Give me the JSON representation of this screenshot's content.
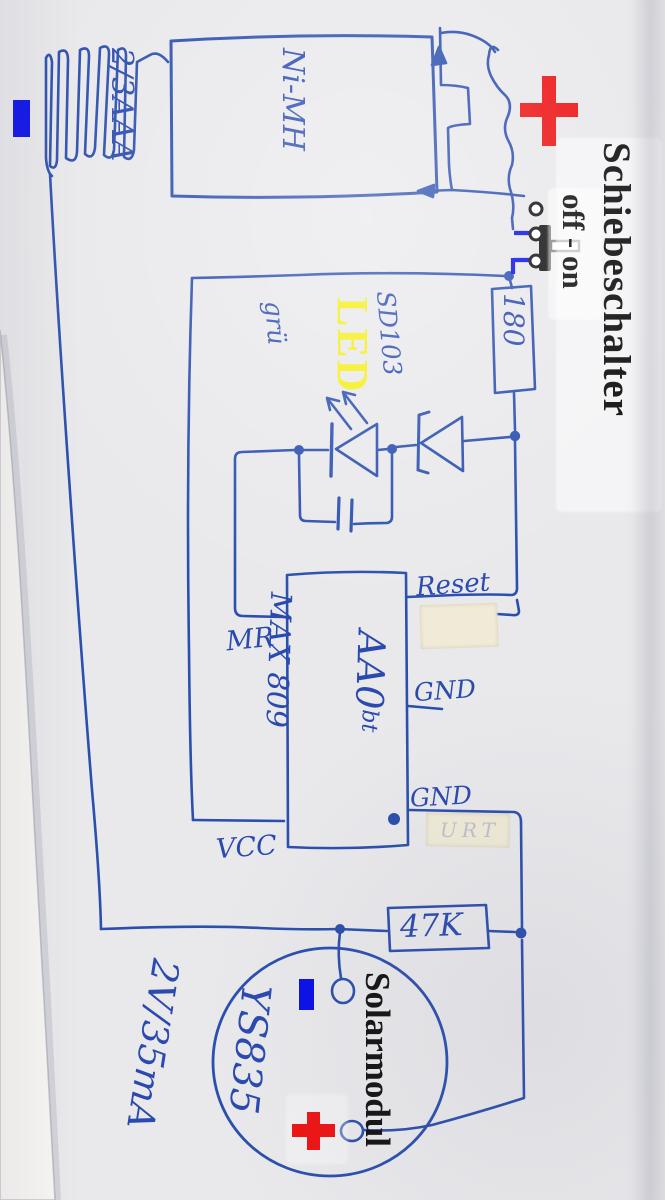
{
  "labels": {
    "switch_name": "Schiebeschalter",
    "switch_positions": "off - on",
    "led": "LED",
    "solar_name": "Solarmodul"
  },
  "battery": {
    "lines": [
      "Ni-MH",
      "2/3AAA",
      "200mAh",
      "1,2 V"
    ]
  },
  "components": {
    "series_resistor": "180",
    "diode_type": "SD103",
    "diode_note": "grü",
    "ic_marking": "AA0",
    "ic_marking_suffix": "bt",
    "ic_part": "MAX 809",
    "sense_resistor": "47K",
    "solar_model": "YS835",
    "solar_rating": "2V/35mA"
  },
  "ic_pins": {
    "reset": "Reset",
    "mr": "MR",
    "gnd_upper": "GND",
    "gnd_lower": "GND",
    "vcc": "VCC"
  },
  "markers": {
    "battery_plus": "+",
    "battery_minus": "−",
    "solar_plus": "+",
    "solar_minus": "−"
  },
  "tape_ghost": "URT",
  "colors": {
    "ink": "#2b4fae",
    "digital_blue": "#0b10e8",
    "marker_red": "#ed1414",
    "led_yellow": "#f5ee16",
    "overlay_black": "#131313",
    "paper": "#e9e9ec",
    "tape": "#efe7d2"
  }
}
